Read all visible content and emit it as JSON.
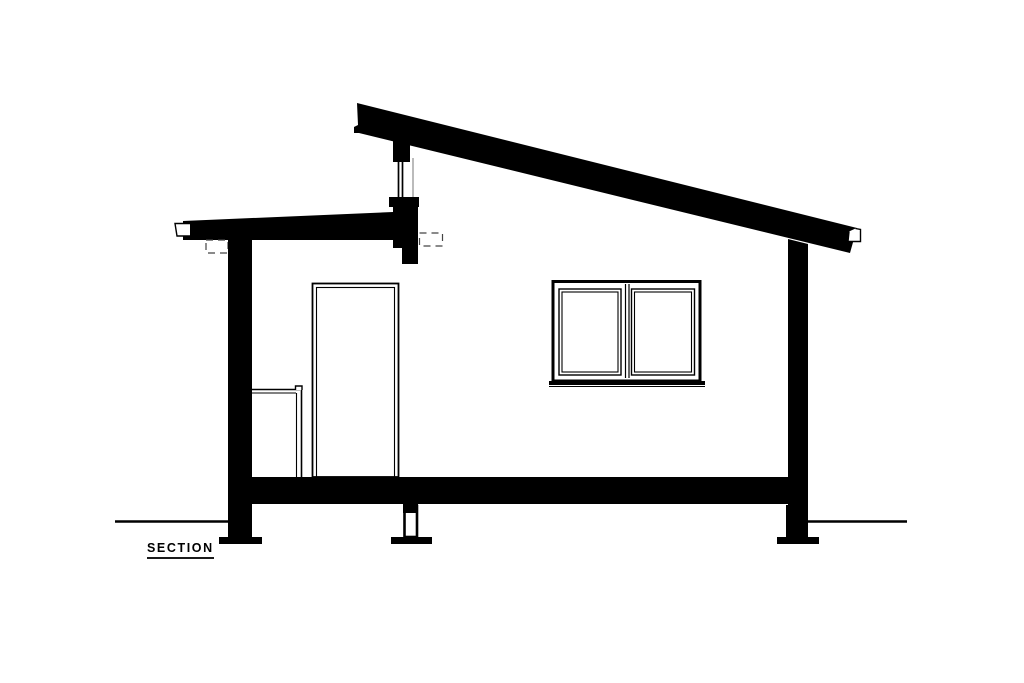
{
  "page": {
    "background_color": "#ffffff",
    "ink_color": "#000000",
    "secondary_line_color": "#555555"
  },
  "drawing": {
    "label": "SECTION",
    "type": "architectural-building-section",
    "description": "Black-and-white sectional drawing of a small shed-roof building with clerestory window, entry door, double window, floor slab and pier foundations"
  }
}
